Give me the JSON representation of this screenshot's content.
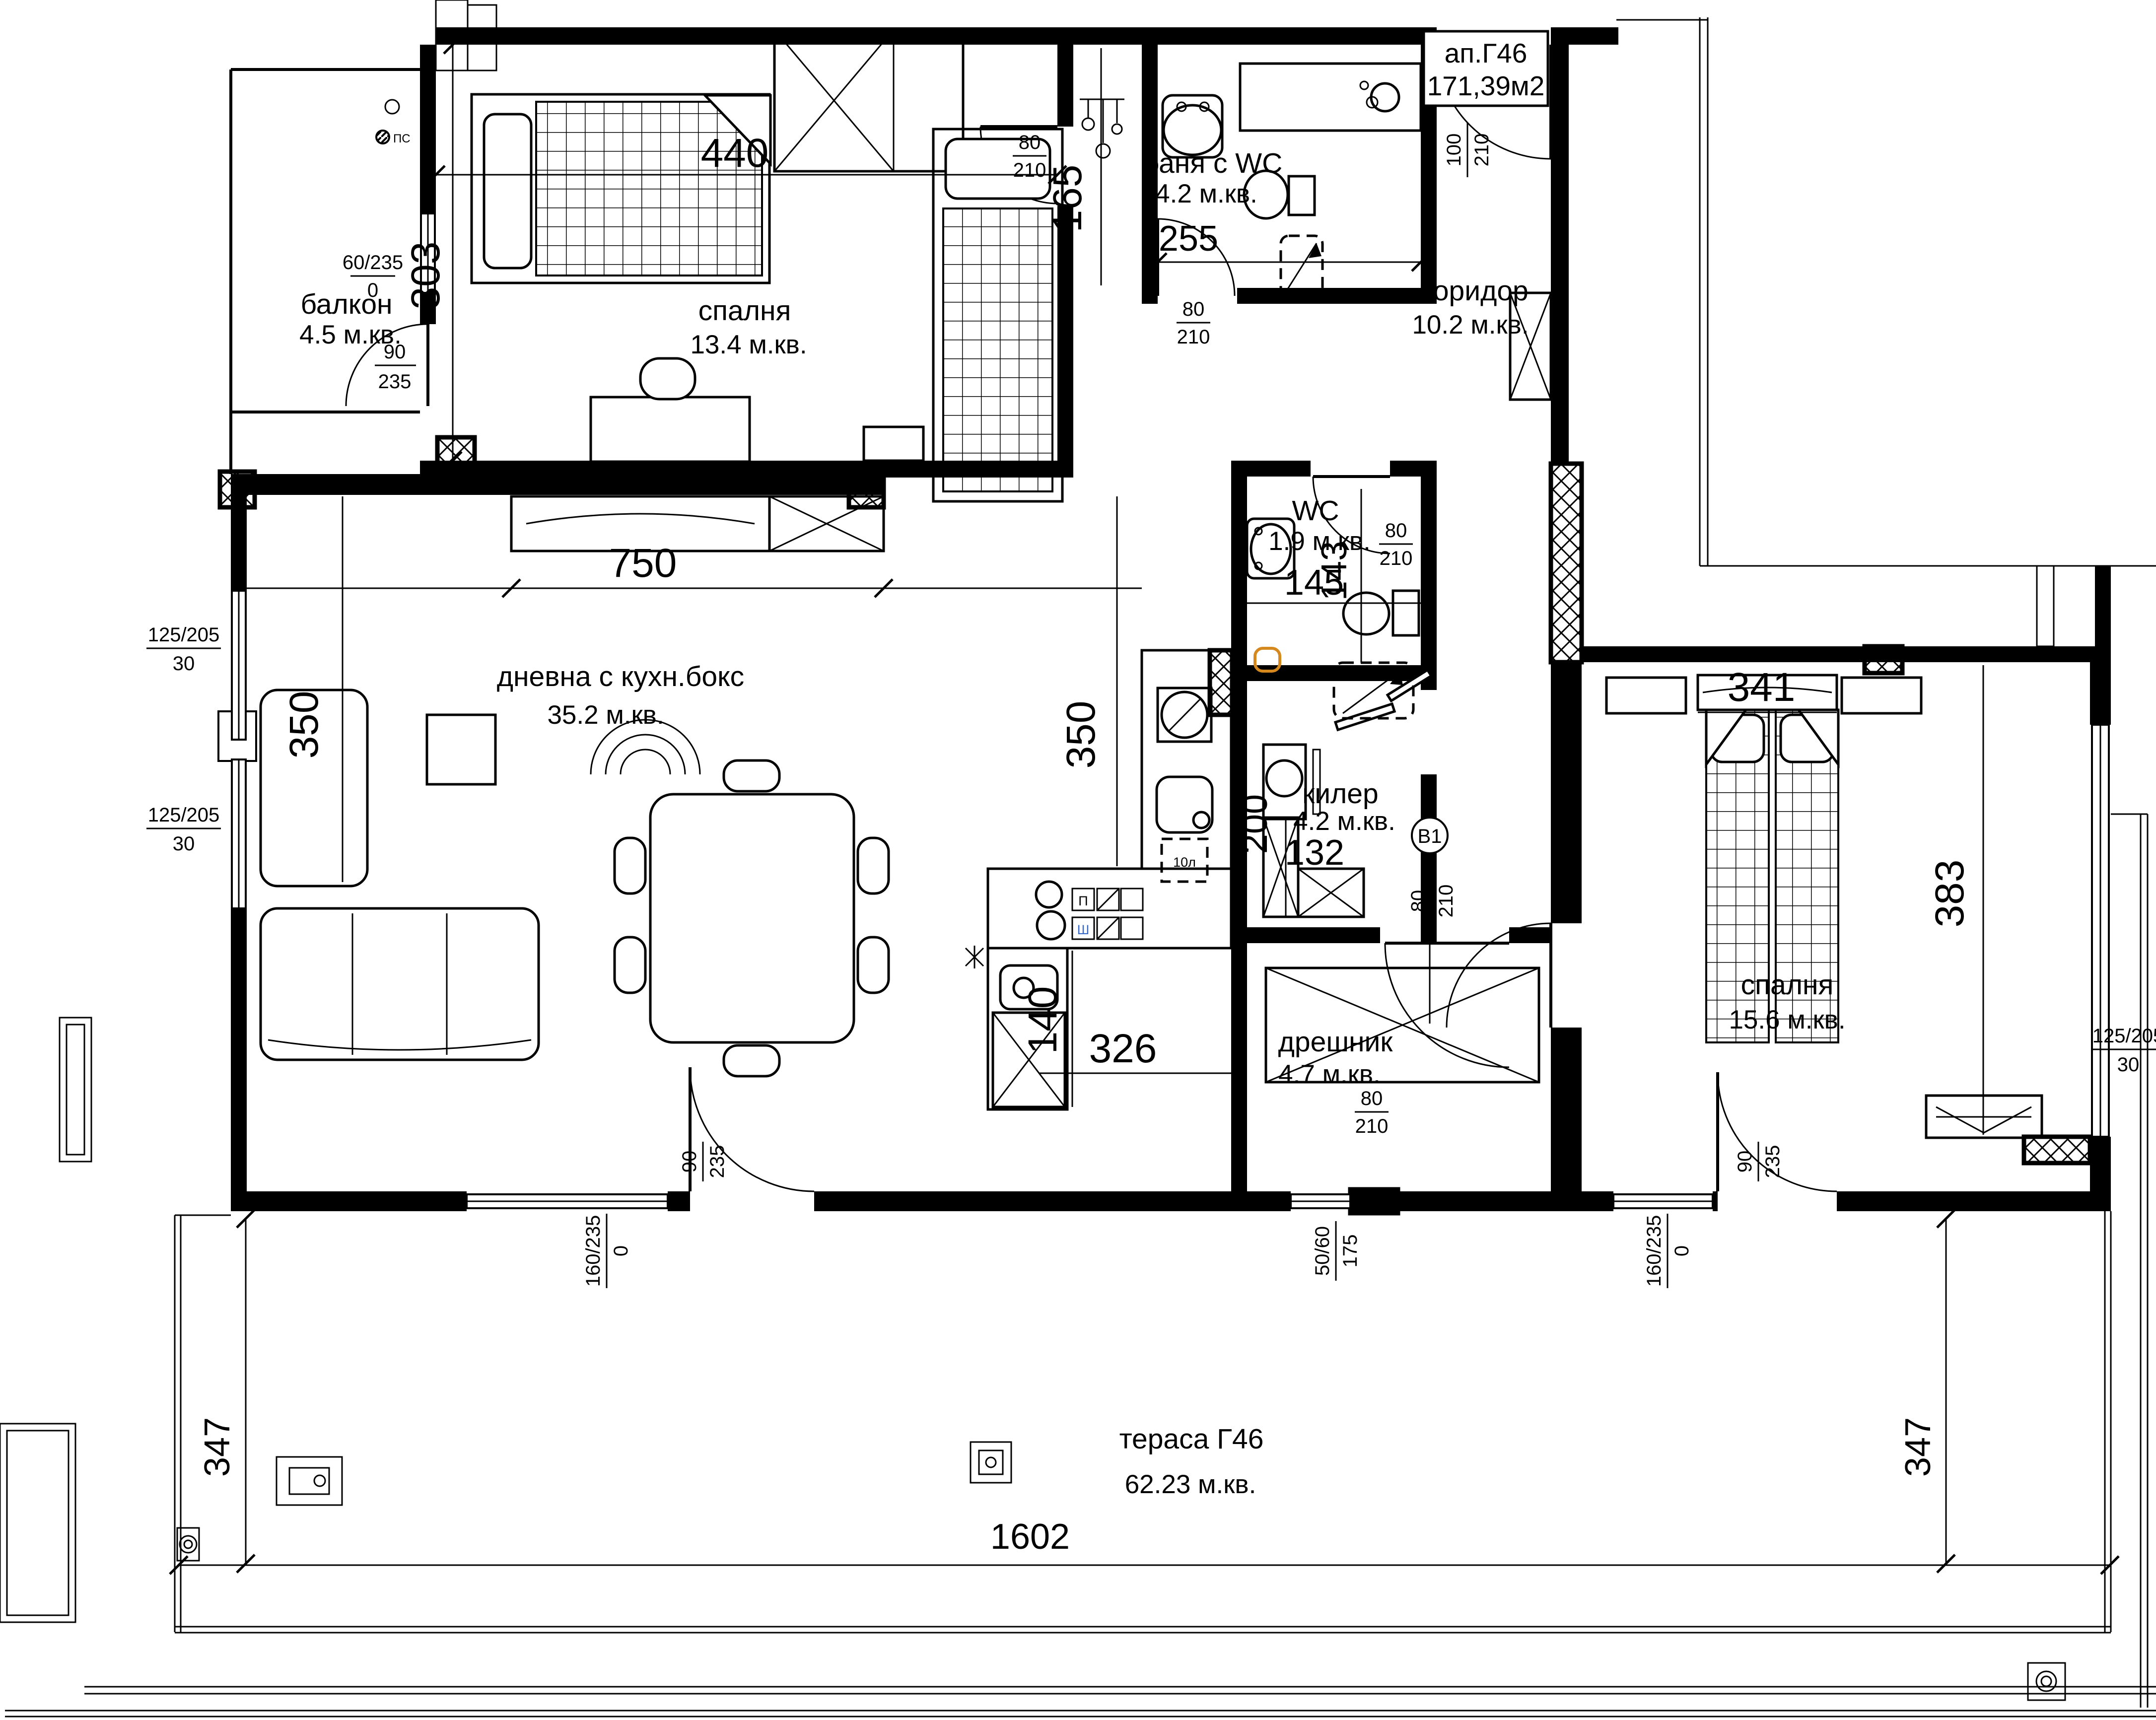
{
  "title": {
    "name": "ап.Г46",
    "area": "171,39м2"
  },
  "rooms": [
    {
      "id": "balcony",
      "name": "балкон",
      "area": "4.5 м.кв."
    },
    {
      "id": "bedroom1",
      "name": "спалня",
      "area": "13.4 м.кв."
    },
    {
      "id": "bath",
      "name": "баня с WC",
      "area": "4.2 м.кв."
    },
    {
      "id": "corridor",
      "name": "коридор",
      "area": "10.2 м.кв."
    },
    {
      "id": "wc",
      "name": "WC",
      "area": "1.9 м.кв."
    },
    {
      "id": "living",
      "name": "дневна с кухн.бокс",
      "area": "35.2 м.кв."
    },
    {
      "id": "pantry",
      "name": "килер",
      "area": "4.2 м.кв."
    },
    {
      "id": "dressing",
      "name": "дрешник",
      "area": "4.7 м.кв."
    },
    {
      "id": "bedroom2",
      "name": "спалня",
      "area": "15.6 м.кв."
    },
    {
      "id": "terrace",
      "name": "тераса Г46",
      "area": "62.23 м.кв."
    }
  ],
  "dims": {
    "w440": "440",
    "v303": "303",
    "v165": "165",
    "h255": "255",
    "h750": "750",
    "v350a": "350",
    "v350b": "350",
    "v200": "200",
    "h145": "145",
    "v143": "143",
    "h132": "132",
    "v140": "140",
    "h326": "326",
    "h341": "341",
    "v383": "383",
    "v347l": "347",
    "v347r": "347",
    "h1602": "1602"
  },
  "openings": {
    "win_balcony": {
      "top": "60/235",
      "bottom": "0"
    },
    "door_balcony": {
      "top": "90",
      "bottom": "235"
    },
    "door_bedroom1": {
      "top": "80",
      "bottom": "210"
    },
    "door_bath": {
      "top": "80",
      "bottom": "210"
    },
    "door_entrance": {
      "top": "100",
      "bottom": "210"
    },
    "door_wc": {
      "top": "80",
      "bottom": "210"
    },
    "door_b1": {
      "top": "80",
      "bottom": "210"
    },
    "door_dressing": {
      "top": "80",
      "bottom": "210"
    },
    "win_left1": {
      "top": "125/205",
      "bottom": "30"
    },
    "win_left2": {
      "top": "125/205",
      "bottom": "30"
    },
    "win_right": {
      "top": "125/205",
      "bottom": "30"
    },
    "win_bottom1": {
      "top": "160/235",
      "bottom": "0"
    },
    "door_terrace1": {
      "top": "90",
      "bottom": "235"
    },
    "win_small": {
      "top": "50/60",
      "bottom": "175"
    },
    "win_bottom2": {
      "top": "160/235",
      "bottom": "0"
    },
    "door_terrace2": {
      "top": "90",
      "bottom": "235"
    }
  },
  "annotations": {
    "ps": "ПС",
    "b1": "B1",
    "boiler": "10л",
    "cabinet_top": "П",
    "cabinet_bottom": "Ш"
  },
  "colors": {
    "ink": "#000000",
    "accent_orange": "#d4881e",
    "accent_blue": "#3a6bc9",
    "paper": "#ffffff"
  }
}
